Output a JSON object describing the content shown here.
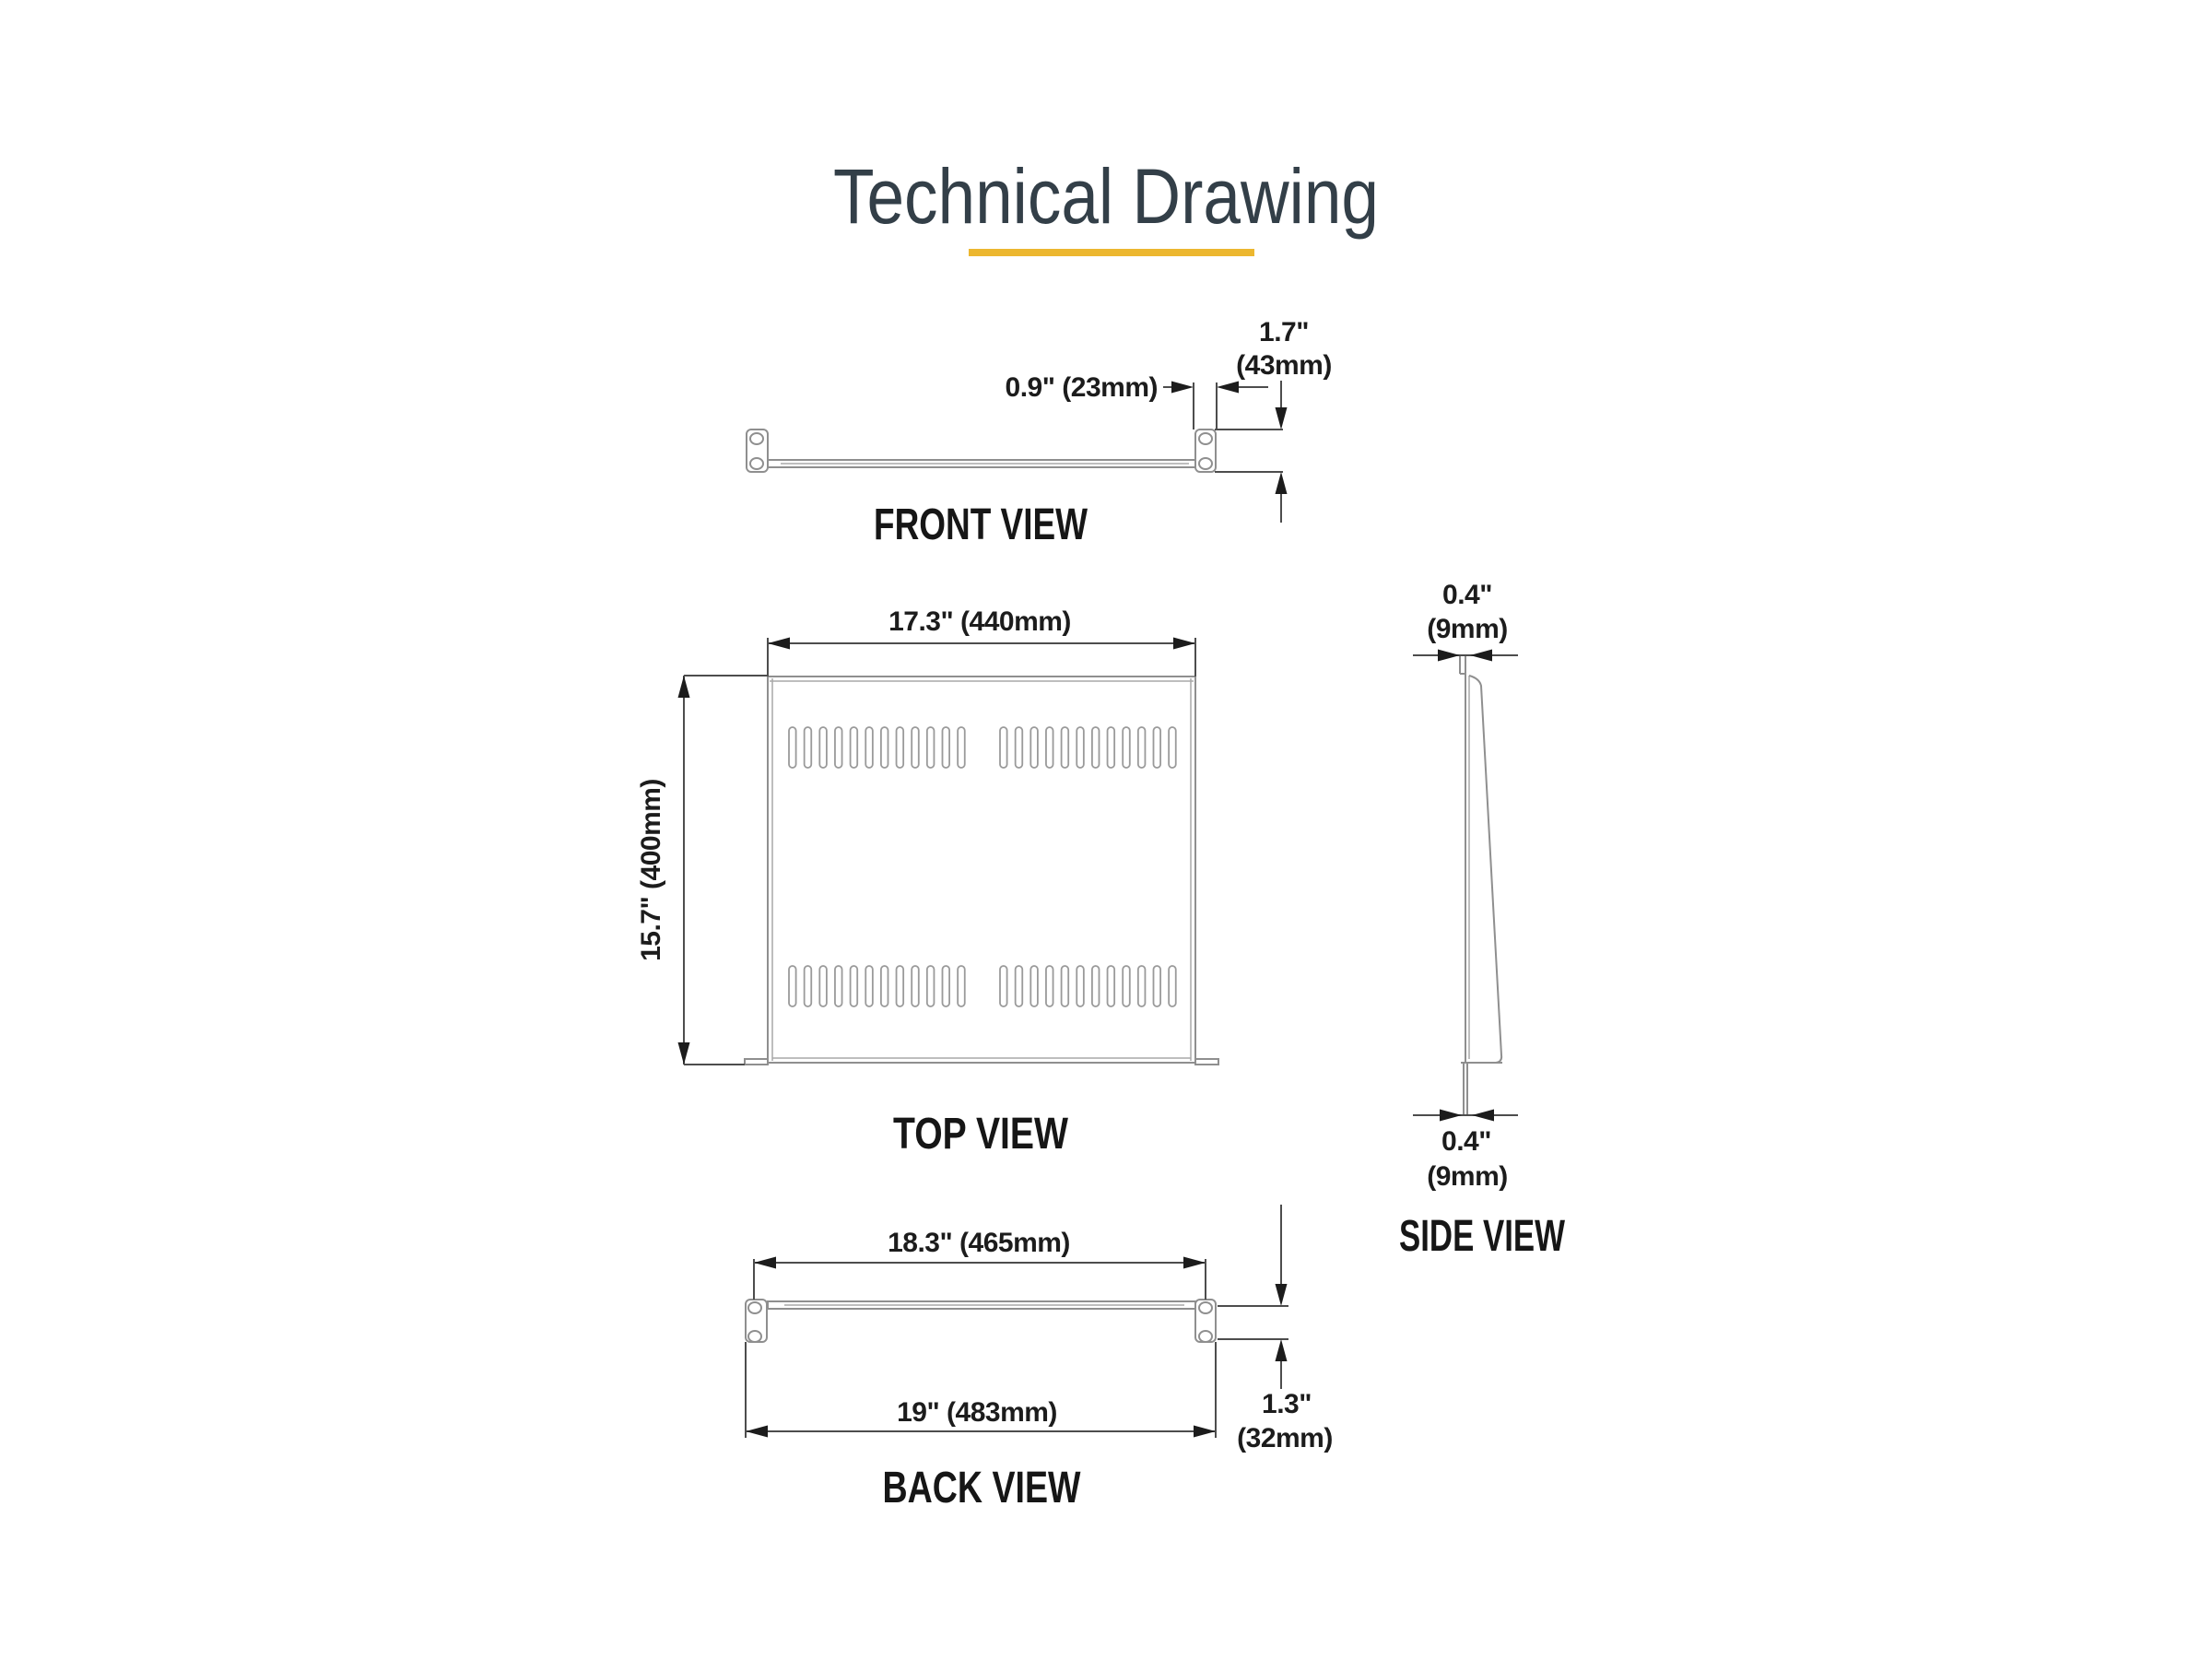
{
  "title": "Technical Drawing",
  "colors": {
    "accent_underline": "#ecb72f",
    "title_text": "#333f48",
    "drawing_line": "#8f8f8f",
    "dimension_line": "#4d4d4d",
    "text": "#1c1c1c"
  },
  "front_view": {
    "label": "FRONT VIEW",
    "dim_ear_width": "0.9\" (23mm)",
    "dim_height_in": "1.7\"",
    "dim_height_mm": "(43mm)"
  },
  "top_view": {
    "label": "TOP VIEW",
    "dim_width": "17.3\" (440mm)",
    "dim_depth": "15.7\" (400mm)",
    "vent_slots": {
      "rows": 2,
      "groups_per_row": 2,
      "slots_per_group": 12
    }
  },
  "side_view": {
    "label": "SIDE VIEW",
    "dim_top_in": "0.4\"",
    "dim_top_mm": "(9mm)",
    "dim_bottom_in": "0.4\"",
    "dim_bottom_mm": "(9mm)"
  },
  "back_view": {
    "label": "BACK VIEW",
    "dim_inner_width": "18.3\" (465mm)",
    "dim_outer_width": "19\" (483mm)",
    "dim_flange_in": "1.3\"",
    "dim_flange_mm": "(32mm)"
  }
}
